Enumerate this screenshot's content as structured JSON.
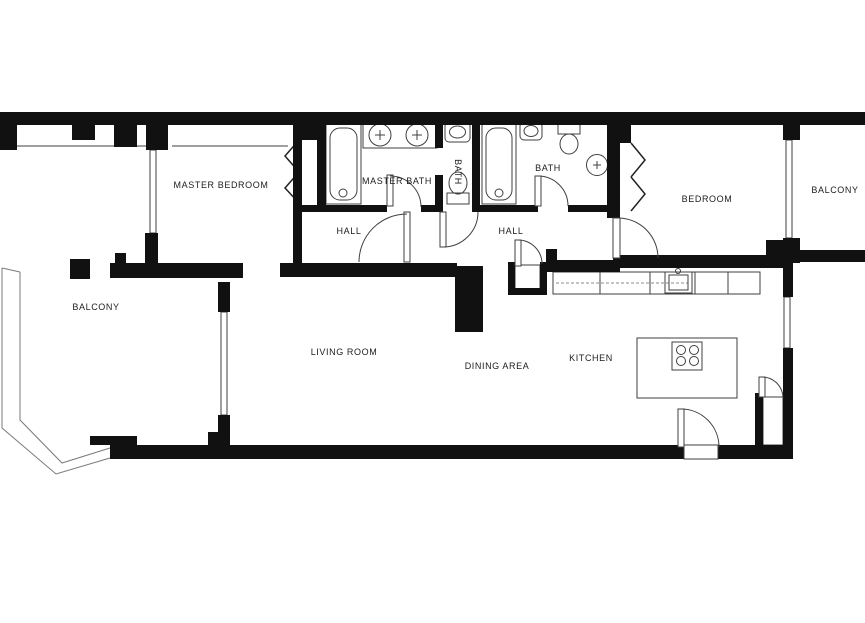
{
  "floor_plan": {
    "title": "Apartment floor plan",
    "rooms": [
      {
        "name": "master-bedroom",
        "label": "MASTER BEDROOM"
      },
      {
        "name": "master-bath",
        "label": "MASTER BATH"
      },
      {
        "name": "bath-wc",
        "label": "BATH"
      },
      {
        "name": "bath-2",
        "label": "BATH"
      },
      {
        "name": "bedroom",
        "label": "BEDROOM"
      },
      {
        "name": "balcony-right",
        "label": "BALCONY"
      },
      {
        "name": "hall-left",
        "label": "HALL"
      },
      {
        "name": "hall-right",
        "label": "HALL"
      },
      {
        "name": "balcony-left",
        "label": "BALCONY"
      },
      {
        "name": "living-room",
        "label": "LIVING ROOM"
      },
      {
        "name": "dining-area",
        "label": "DINING AREA"
      },
      {
        "name": "kitchen",
        "label": "KITCHEN"
      }
    ],
    "fixtures": [
      "bathtub",
      "double-sink-vanity",
      "sink",
      "toilet",
      "washer",
      "kitchen-counter",
      "kitchen-sink",
      "kitchen-island",
      "stove",
      "bifold-closet-doors",
      "swing-door",
      "window",
      "balcony-railing"
    ],
    "colors": {
      "wall": "#111111",
      "fixture_line": "#3f3f3f",
      "railing_line": "#777777",
      "background": "#ffffff"
    }
  }
}
